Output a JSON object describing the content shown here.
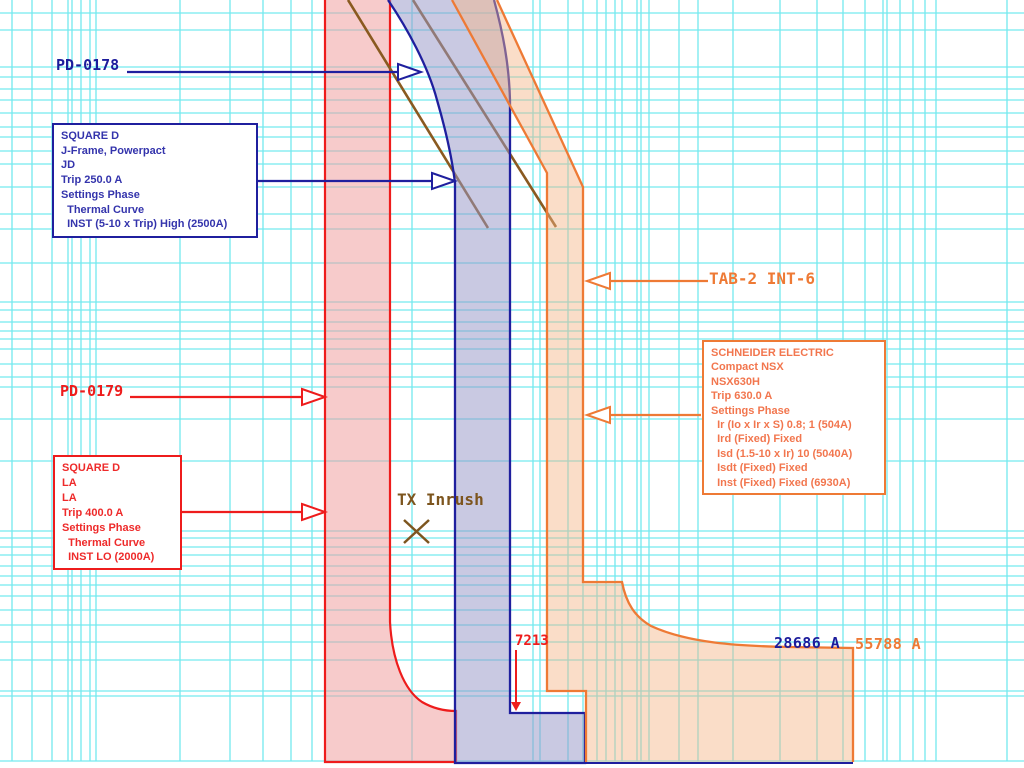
{
  "chart_data": {
    "type": "line",
    "subtype": "time-current-curve (TCC) protective-device coordination plot, log-log grid",
    "title": "",
    "axes_visible": false,
    "grid": "cyan log-log graph grid; axis tick labels outside the cropped view",
    "series": [
      {
        "name": "PD-0178",
        "device": "SQUARE D J-Frame, Powerpact JD",
        "trip_a": 250.0,
        "settings": [
          "Thermal Curve",
          "INST (5-10 x Trip) High (2500A)"
        ],
        "curve_color": "#1f1f9e",
        "band_fill": "#cdcde5",
        "shape": "thermal band entering top-left of band, vertical instantaneous band, step-out at bottom"
      },
      {
        "name": "PD-0179",
        "device": "SQUARE D LA",
        "trip_a": 400.0,
        "settings": [
          "Thermal Curve",
          "INST LO (2000A)"
        ],
        "curve_color": "#ee1c1c",
        "band_fill": "#f7d2d2",
        "shape": "vertical thermal band with knee curving right into instantaneous region at bottom"
      },
      {
        "name": "TAB-2 INT-6",
        "device": "SCHNEIDER ELECTRIC Compact NSX NSX630H",
        "trip_a": 630.0,
        "settings": [
          "Ir (Io x Ir x S) 0.8; 1 (504A)",
          "Ird (Fixed) Fixed",
          "Isd (1.5-10 x Ir) 10 (5040A)",
          "Isdt (Fixed) Fixed",
          "Inst (Fixed) Fixed (6930A)"
        ],
        "curve_color": "#ee7a35",
        "band_fill": "#fbe0cb",
        "shape": "diagonal long-time band, vertical Ir band, short-time shelf extending right, instantaneous drop"
      }
    ],
    "annotations": [
      {
        "label": "TX Inrush",
        "marker": "x-cross",
        "color": "#7d551e"
      },
      {
        "label": "7213",
        "meaning": "fault-current marker (A), partially covered by orange band",
        "color": "#ee1c1c"
      },
      {
        "label": "28686 A",
        "meaning": "fault-current value",
        "color": "#1c1c9c"
      },
      {
        "label": "55788 A",
        "meaning": "fault-current value",
        "color": "#ee7a35"
      }
    ],
    "extra_curves": [
      "two brown diagonal damage/withstand curves ending mid-plot"
    ],
    "legend_position": "callout boxes with leader arrows"
  },
  "labels": {
    "pd0178": "PD-0178",
    "pd0179": "PD-0179",
    "tab2": "TAB-2 INT-6",
    "tx_inrush": "TX Inrush",
    "m7213": "7213",
    "m28686": "28686 A",
    "m55788": "55788 A"
  },
  "boxes": {
    "jd": {
      "lines": [
        "SQUARE D",
        "J-Frame, Powerpact",
        "JD",
        "Trip 250.0 A",
        "Settings Phase",
        "  Thermal Curve",
        "  INST (5-10 x Trip) High (2500A)"
      ]
    },
    "la": {
      "lines": [
        "SQUARE D",
        "LA",
        "LA",
        "Trip 400.0 A",
        "Settings Phase",
        "  Thermal Curve",
        "  INST LO (2000A)"
      ]
    },
    "nsx": {
      "lines": [
        "SCHNEIDER ELECTRIC",
        "Compact NSX",
        "NSX630H",
        "Trip 630.0 A",
        "Settings Phase",
        "  Ir (Io x Ir x S) 0.8; 1 (504A)",
        "  Ird (Fixed) Fixed",
        "  Isd (1.5-10 x Ir) 10 (5040A)",
        "  Isdt (Fixed) Fixed",
        "  Inst (Fixed) Fixed (6930A)"
      ]
    }
  },
  "colors": {
    "navy": "#1f1f9e",
    "red": "#ee1c1c",
    "orange": "#ee7a35",
    "brown": "#8a5a20",
    "grid_cyan": "#74e9ef",
    "pink_band": "#f7d2d2",
    "lavender_band": "#cdcde5",
    "peach_band": "#fbe0cb"
  }
}
